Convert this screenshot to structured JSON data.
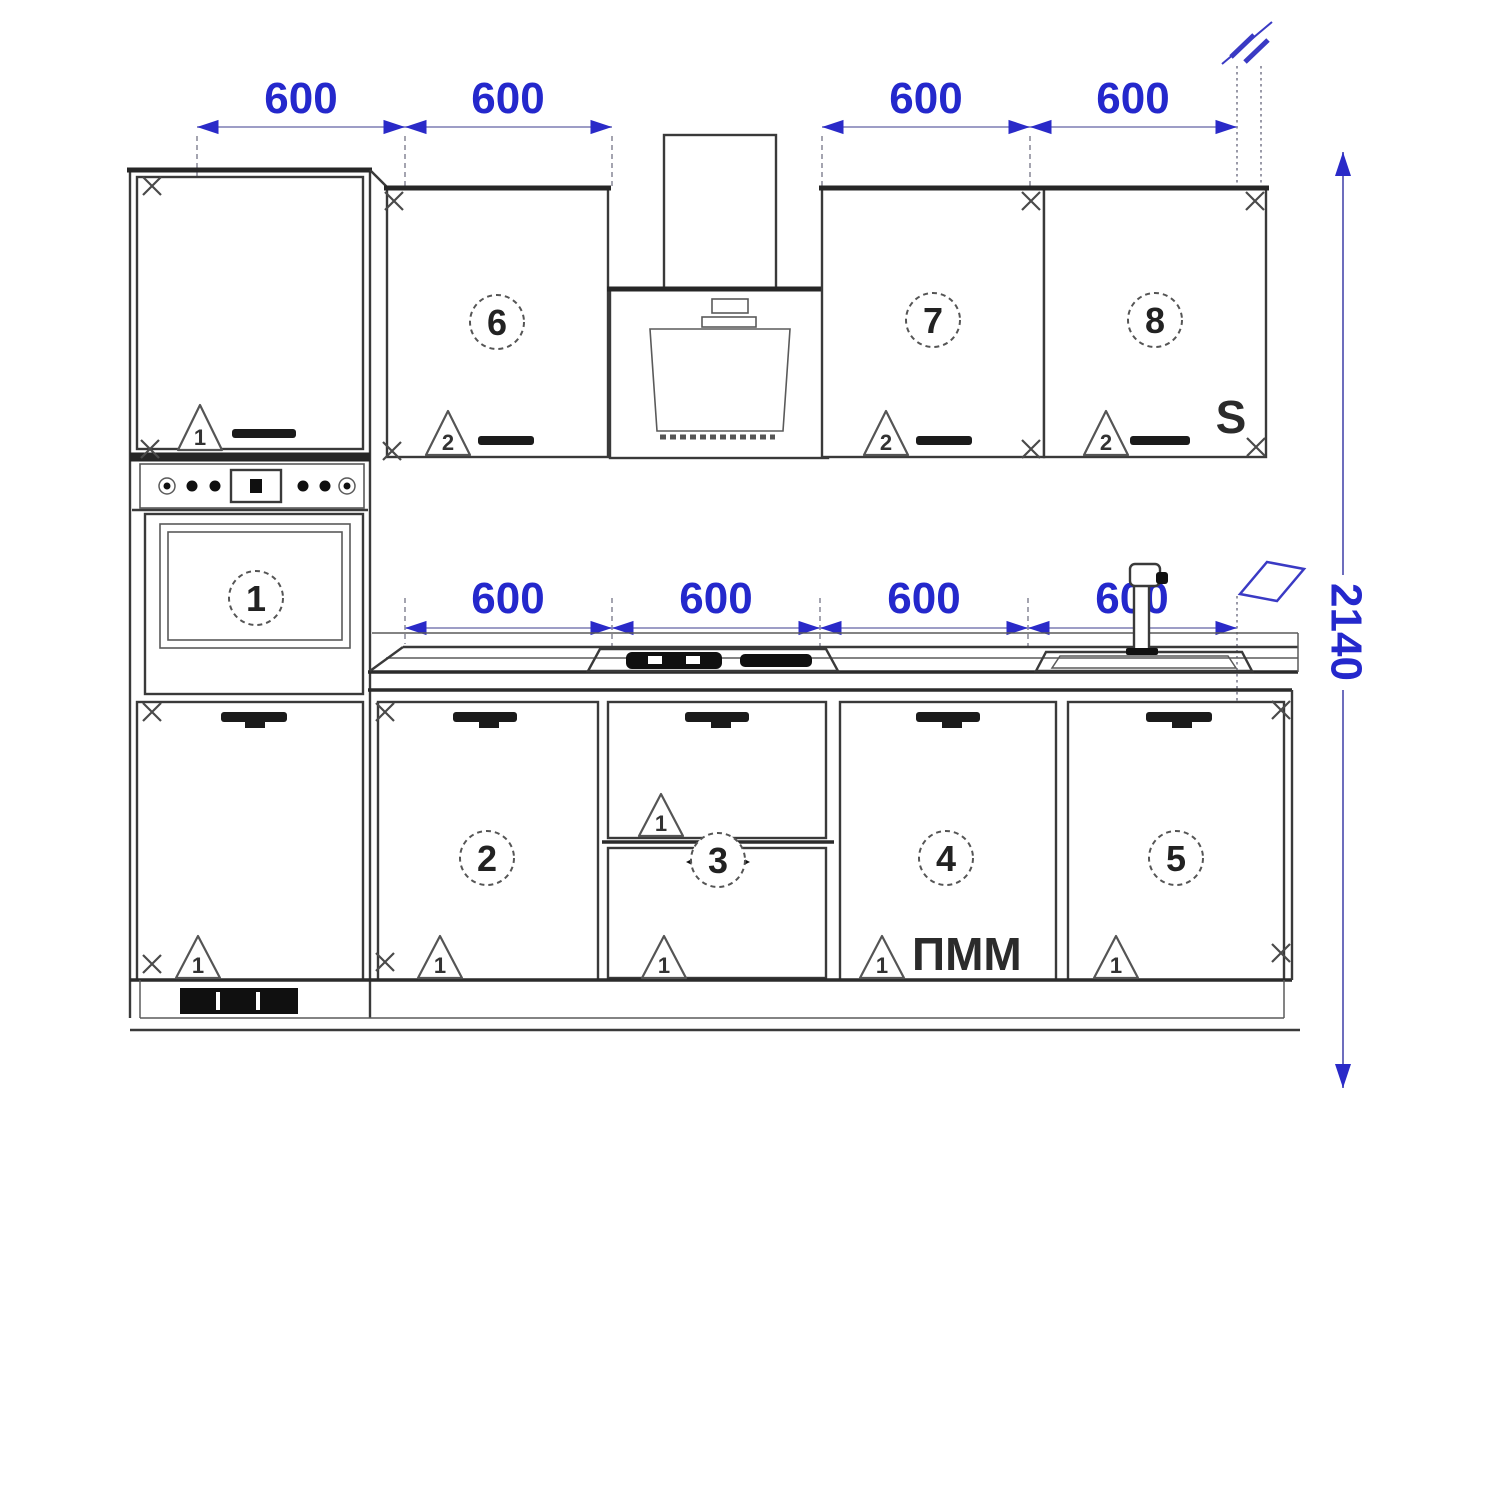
{
  "drawing": {
    "type": "kitchen-elevation",
    "dimensions_mm": {
      "top_row": [
        "600",
        "600",
        "600",
        "600"
      ],
      "counter_row": [
        "600",
        "600",
        "600",
        "600"
      ],
      "total_height": "2140"
    },
    "unit_labels": {
      "oven": "1",
      "base_2": "2",
      "base_3": "3",
      "base_4": "4",
      "base_5": "5",
      "wall_6": "6",
      "wall_7": "7",
      "wall_8": "8"
    },
    "assembly_markers": {
      "tall_upper": "1",
      "tall_lower": "1",
      "wall_6": "2",
      "wall_7": "2",
      "wall_8": "2",
      "base_2": "1",
      "base_3_upper": "1",
      "base_3_lower": "1",
      "base_4": "1",
      "base_5": "1"
    },
    "text_annotations": {
      "sink_cabinet_marker": "S",
      "dishwasher_label": "ПММ"
    },
    "colors": {
      "dimension_text": "#2428cc",
      "dimension_line": "#8f8fbe",
      "dimension_accent": "#2a2ac8",
      "outline": "#3a3a3a",
      "outline_heavy": "#262626",
      "extension_line": "#9b9ba8",
      "background": "#ffffff"
    }
  }
}
